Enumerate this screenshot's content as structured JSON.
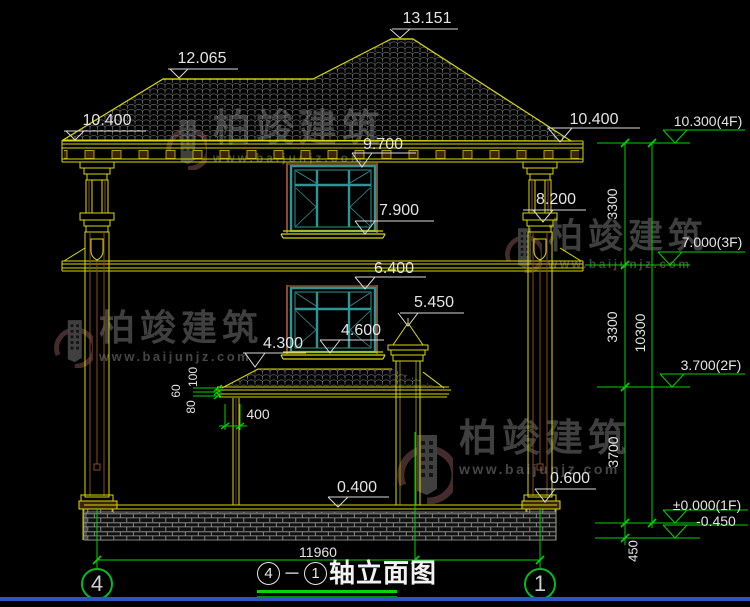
{
  "watermark": {
    "brand": "柏竣建筑",
    "url": "www.baijunjz.com"
  },
  "title": {
    "axis_from": "4",
    "axis_to": "1",
    "text": "轴立面图"
  },
  "axes": {
    "left": "4",
    "right": "1"
  },
  "colors": {
    "line_yellow": "#d8d800",
    "line_green": "#00d400",
    "line_brown": "#8a4a28",
    "window_teal": "#2f9494",
    "tile_grey": "#909090",
    "dim_text": "#e4e4e4",
    "window_border_blue": "#2b55c5"
  },
  "annotations": [
    {
      "name": "elev-ridge-main",
      "text": "13.151",
      "x": 427,
      "y": 19
    },
    {
      "name": "elev-ridge-left",
      "text": "12.065",
      "x": 202,
      "y": 59
    },
    {
      "name": "elev-eave-left",
      "text": "10.400",
      "x": 107,
      "y": 121
    },
    {
      "name": "elev-eave-right",
      "text": "10.400",
      "x": 594,
      "y": 120
    },
    {
      "name": "elev-window-top",
      "text": "9.700",
      "x": 383,
      "y": 145
    },
    {
      "name": "elev-window-sill",
      "text": "7.900",
      "x": 399,
      "y": 211
    },
    {
      "name": "elev-column-band",
      "text": "8.200",
      "x": 556,
      "y": 200
    },
    {
      "name": "elev-lower-window-top",
      "text": "6.400",
      "x": 394,
      "y": 269
    },
    {
      "name": "elev-chimney-top",
      "text": "5.450",
      "x": 434,
      "y": 303
    },
    {
      "name": "elev-lower-sill",
      "text": "4.600",
      "x": 361,
      "y": 331
    },
    {
      "name": "elev-porch-roof",
      "text": "4.300",
      "x": 283,
      "y": 344
    },
    {
      "name": "dim-porch-offset",
      "text": "400",
      "x": 258,
      "y": 414,
      "size": 14
    },
    {
      "name": "elev-ground",
      "text": "0.400",
      "x": 357,
      "y": 488
    },
    {
      "name": "elev-column-base",
      "text": "0.600",
      "x": 570,
      "y": 479
    },
    {
      "name": "dim-total-width",
      "text": "11960",
      "x": 318,
      "y": 552,
      "size": 14
    },
    {
      "name": "level-4f",
      "text": "10.300(4F)",
      "x": 708,
      "y": 121,
      "size": 14
    },
    {
      "name": "level-3f",
      "text": "7.000(3F)",
      "x": 712,
      "y": 242,
      "size": 14
    },
    {
      "name": "level-2f",
      "text": "3.700(2F)",
      "x": 711,
      "y": 365,
      "size": 14
    },
    {
      "name": "level-1f",
      "text": "±0.000(1F)",
      "x": 707,
      "y": 505,
      "size": 14
    },
    {
      "name": "level-footing",
      "text": "-0.450",
      "x": 716,
      "y": 521,
      "size": 14
    },
    {
      "name": "dim-floor-upper",
      "text": "3300",
      "x": 612,
      "y": 204,
      "rot": -90,
      "size": 14
    },
    {
      "name": "dim-floor-lower",
      "text": "3300",
      "x": 612,
      "y": 327,
      "rot": -90,
      "size": 14
    },
    {
      "name": "dim-total-height",
      "text": "10300",
      "x": 640,
      "y": 333,
      "rot": -90,
      "size": 14
    },
    {
      "name": "dim-first-floor",
      "text": "3700",
      "x": 613,
      "y": 452,
      "rot": -90,
      "size": 14
    },
    {
      "name": "dim-footing",
      "text": "450",
      "x": 633,
      "y": 551,
      "rot": -90,
      "size": 13
    },
    {
      "name": "dim-eave-100",
      "text": "100",
      "x": 193,
      "y": 377,
      "rot": -90,
      "size": 12
    },
    {
      "name": "dim-eave-60",
      "text": "60",
      "x": 176,
      "y": 391,
      "rot": -90,
      "size": 12
    },
    {
      "name": "dim-eave-80",
      "text": "80",
      "x": 191,
      "y": 407,
      "rot": -90,
      "size": 12
    }
  ]
}
